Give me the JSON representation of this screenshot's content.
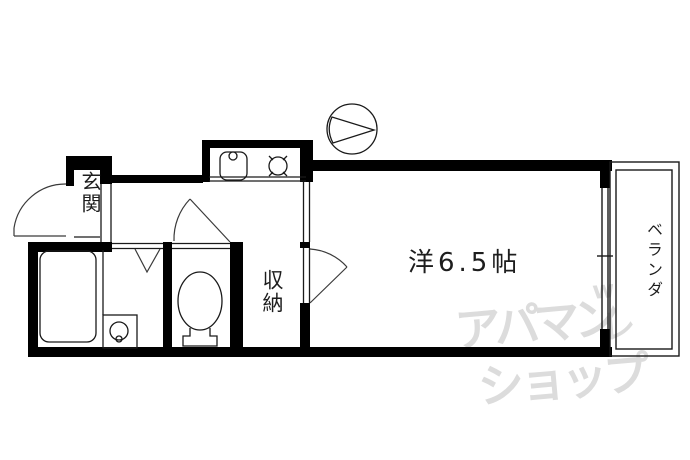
{
  "floor_plan": {
    "background_color": "#ffffff",
    "line_color": "#1a1a1a",
    "wall_color": "#000000",
    "watermark_color": "#dcdcdc",
    "rooms": {
      "entrance": {
        "label": "玄関"
      },
      "main_room": {
        "label": "洋6.5帖"
      },
      "storage": {
        "label": "収納"
      },
      "balcony": {
        "label": "ベランダ"
      }
    },
    "fixtures": {
      "kitchen_sink": "sink-with-faucet-icon",
      "stove": "single-burner-icon",
      "ventilation_fan": "fan-symbol-icon",
      "bathtub": "bathtub-icon",
      "washbasin": "washbasin-icon",
      "toilet": "toilet-icon",
      "bathroom_door": "folding-door-v-mark",
      "doors": "swing-arc-marks",
      "balcony_window": "sliding-window-double-line"
    },
    "watermark": {
      "line1": "アパマン",
      "line2": "ショップ",
      "mark_w": "w",
      "mark_check": "レ"
    }
  }
}
